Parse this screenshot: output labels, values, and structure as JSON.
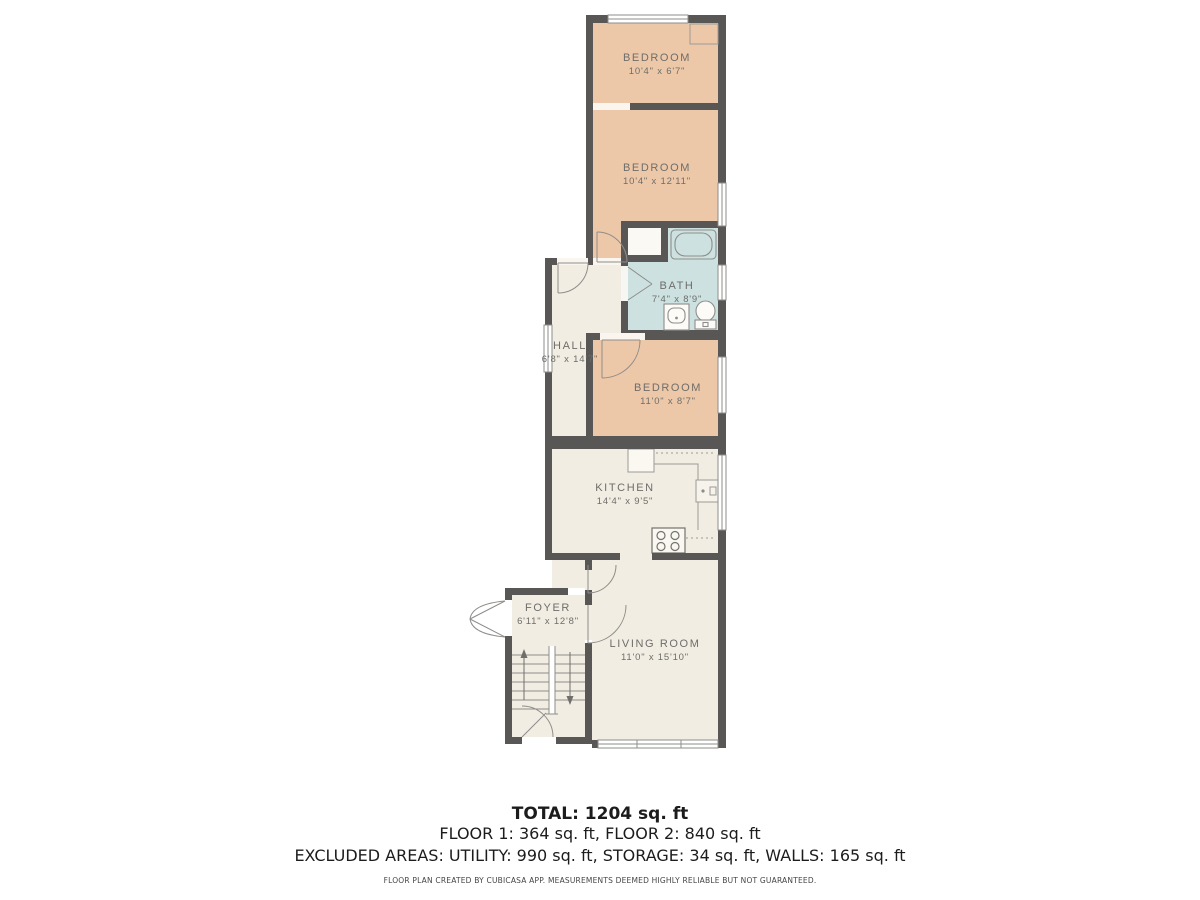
{
  "plan": {
    "rooms": [
      {
        "name": "BEDROOM",
        "dims": "10'4\" x 6'7\""
      },
      {
        "name": "BEDROOM",
        "dims": "10'4\" x 12'11\""
      },
      {
        "name": "BATH",
        "dims": "7'4\" x 8'9\""
      },
      {
        "name": "HALL",
        "dims": "6'8\" x 14'7\""
      },
      {
        "name": "BEDROOM",
        "dims": "11'0\" x 8'7\""
      },
      {
        "name": "KITCHEN",
        "dims": "14'4\" x 9'5\""
      },
      {
        "name": "FOYER",
        "dims": "6'11\" x 12'8\""
      },
      {
        "name": "LIVING ROOM",
        "dims": "11'0\" x 15'10\""
      }
    ],
    "colors": {
      "wall": "#585756",
      "bedroom_fill": "#edc8a8",
      "bath_fill": "#cde2e0",
      "neutral_fill": "#f2ede3",
      "label_text": "#6e6d6a"
    }
  },
  "summary": {
    "total": "TOTAL: 1204 sq. ft",
    "floors": "FLOOR 1: 364 sq. ft, FLOOR 2: 840 sq. ft",
    "excluded": "EXCLUDED AREAS: UTILITY: 990 sq. ft, STORAGE: 34 sq. ft, WALLS: 165 sq. ft",
    "disclaimer": "FLOOR PLAN CREATED BY CUBICASA APP. MEASUREMENTS DEEMED HIGHLY RELIABLE BUT NOT GUARANTEED."
  }
}
